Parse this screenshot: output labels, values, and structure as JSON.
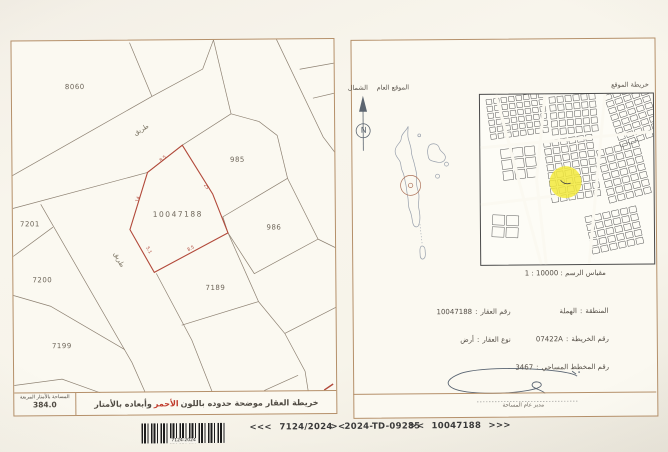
{
  "left_panel": {
    "plots": [
      {
        "label": "8060"
      },
      {
        "label": "7201"
      },
      {
        "label": "7200"
      },
      {
        "label": "7199"
      },
      {
        "label": "10047188"
      },
      {
        "label": "985"
      },
      {
        "label": "986"
      },
      {
        "label": "7189"
      }
    ],
    "roads": [
      "طريق",
      "طريق"
    ],
    "dims": [
      "8.5",
      "14",
      "25",
      "8.5",
      "5.1"
    ],
    "footer": {
      "area_label": "المساحة بالأمتار المربعة",
      "area_value": "384.0",
      "note_pre": "خريطة العقار موضحة حدوده باللون",
      "note_red": "الأحمر",
      "note_post": "وأبعاده بالأمتار"
    }
  },
  "right_panel": {
    "north_label": "الشمال",
    "general_location_label": "الموقع العام",
    "location_map_label": "خريطة الموقع",
    "compass_n": "N",
    "scale_label": "مقياس الرسم : 10000 : 1",
    "field_sep": ":",
    "fields": {
      "area": {
        "label": "المنطقة",
        "value": "الهملة"
      },
      "parcel": {
        "label": "رقم العقار",
        "value": "10047188"
      },
      "map_no": {
        "label": "رقم الخريطة",
        "value": "07422A"
      },
      "type": {
        "label": "نوع العقار",
        "value": "أرض"
      },
      "survey_plan": {
        "label": "رقم المخطط المساحي",
        "value": "3467"
      }
    },
    "signature_caption": "مدير عام المساحة"
  },
  "bottom_bar": {
    "barcode_text": "7124-2024",
    "codes": [
      "<<<",
      "7124/2024",
      "><",
      "2024-TD-09285",
      "><",
      "10047188",
      ">>>"
    ]
  },
  "colors": {
    "panel_border": "#b5906a",
    "boundary_red": "#b2493a",
    "red_word": "#c03a2b",
    "highlight_yellow": "#f2e93c"
  }
}
